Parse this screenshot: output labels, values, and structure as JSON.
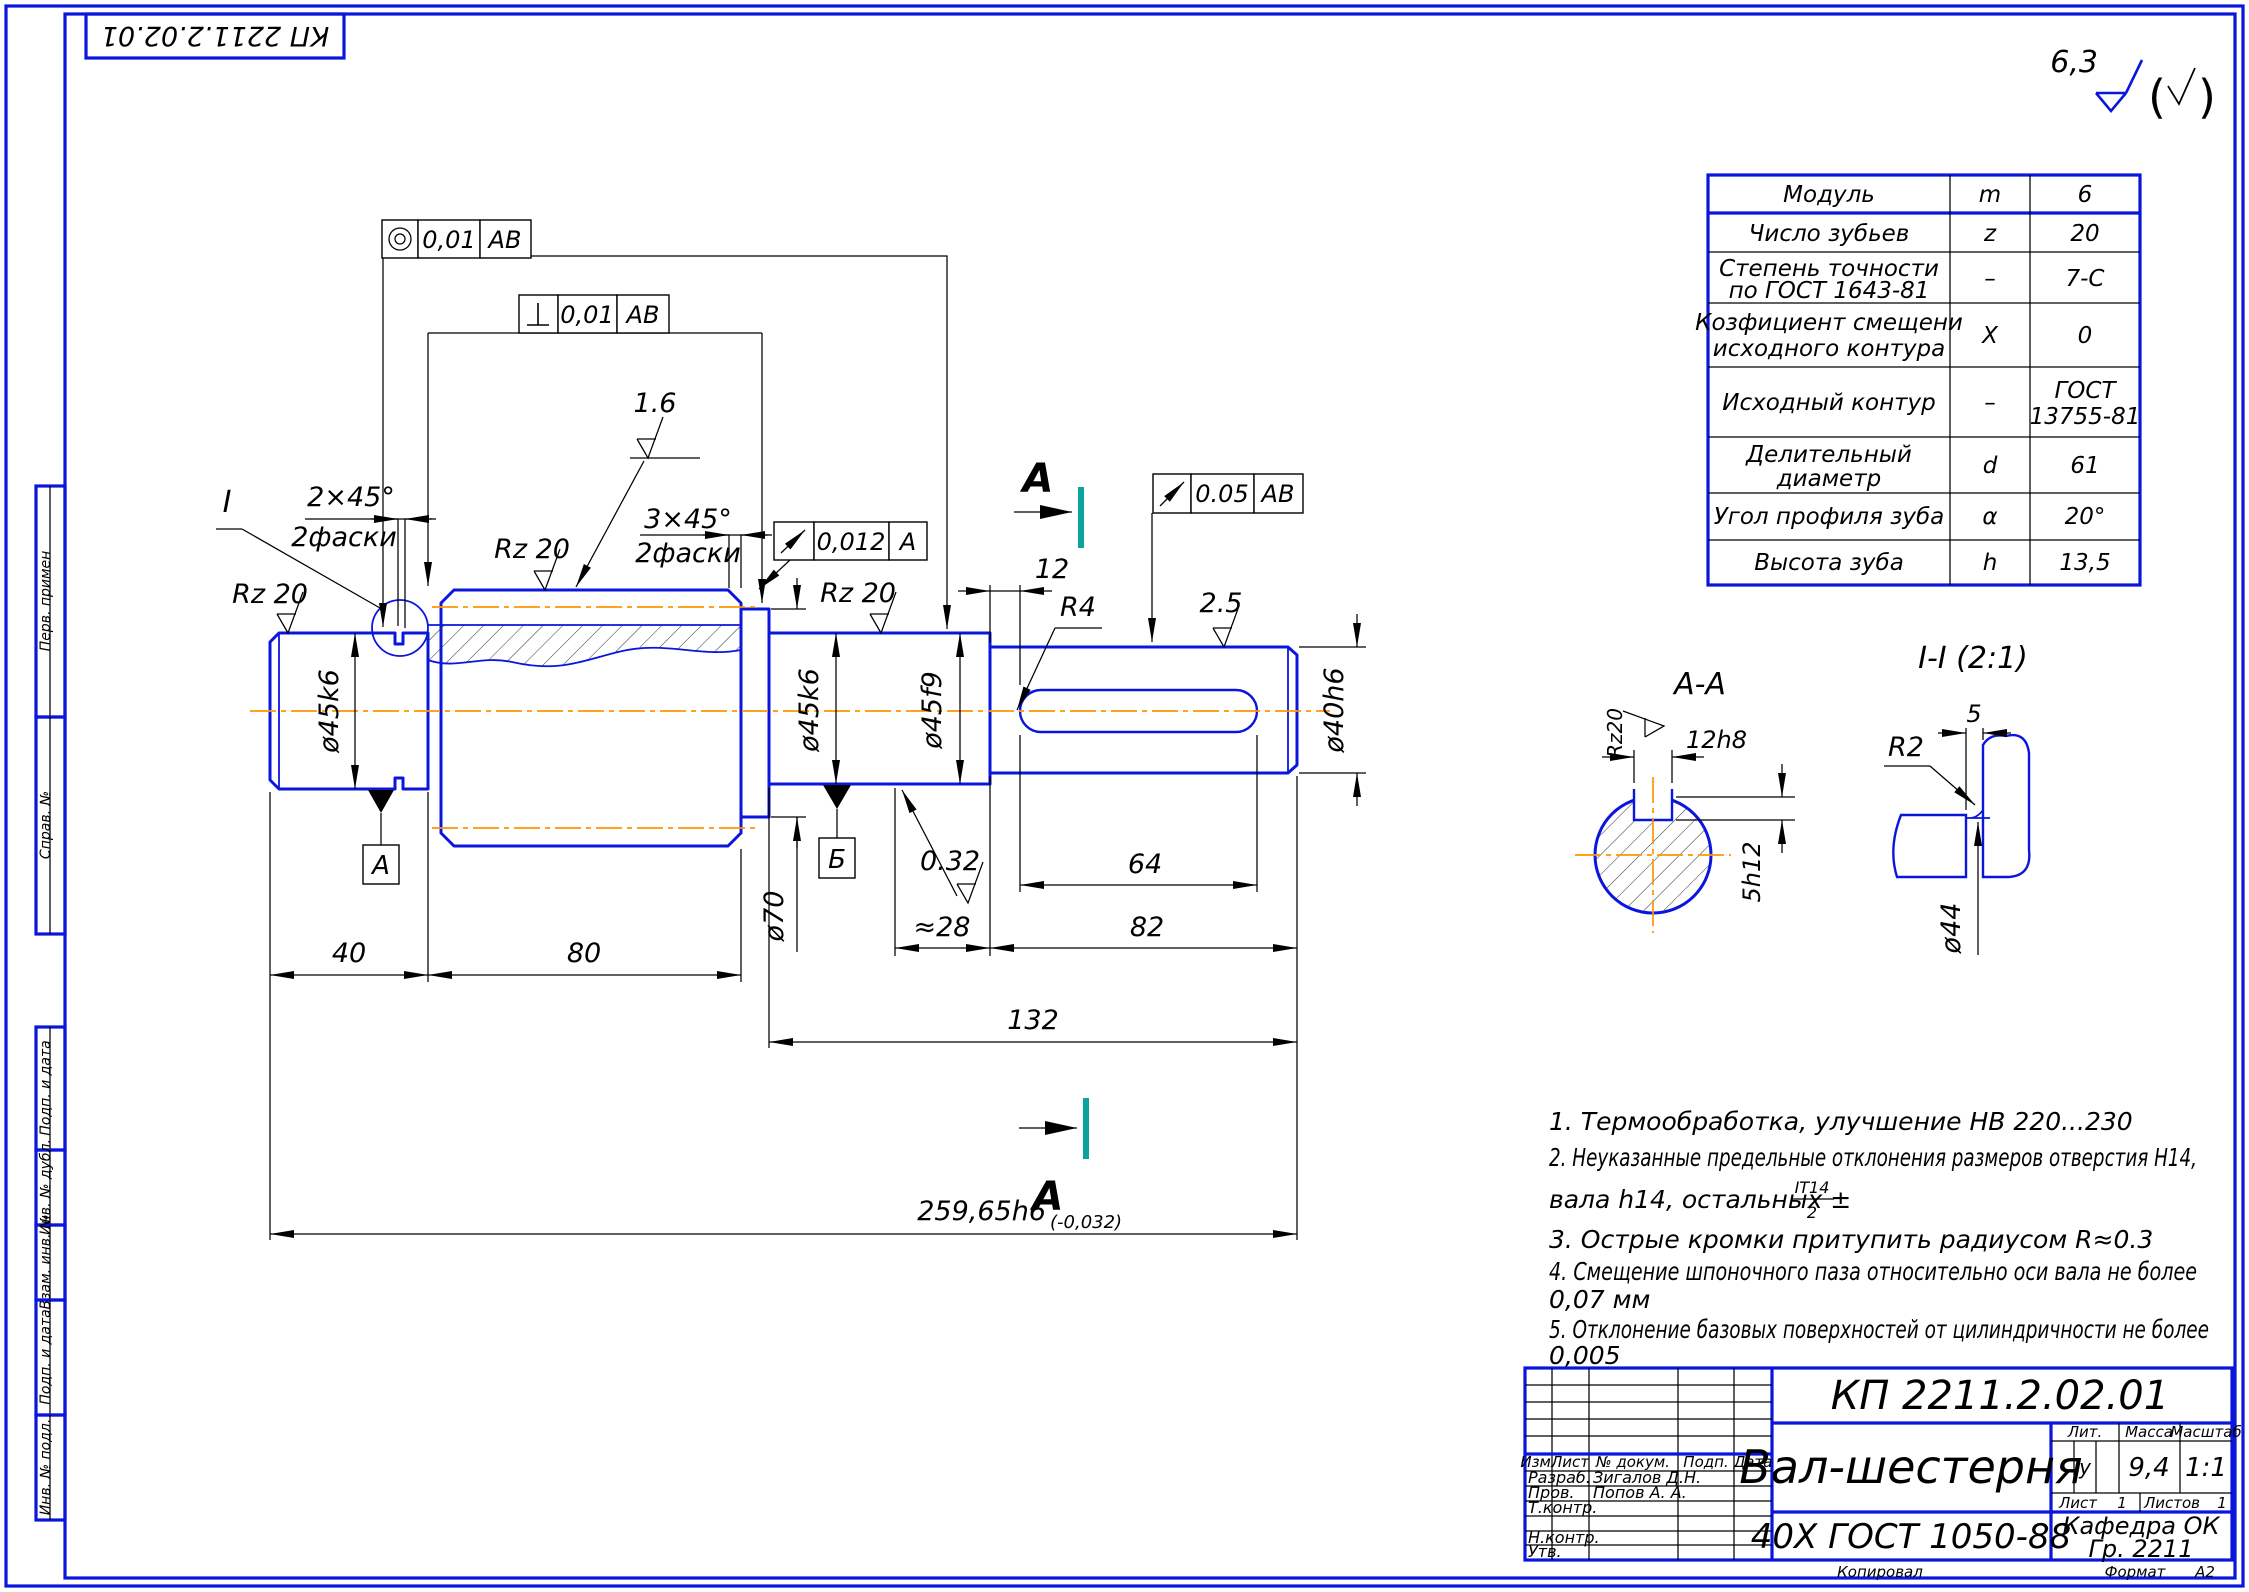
{
  "page": {
    "stamp": "КП 2211.2.02.01"
  },
  "general": {
    "roughness": "6,3"
  },
  "sidebar": {
    "cells": [
      "Перв. примен",
      "Справ. №",
      "Подп. и дата",
      "Инв. № дубл.",
      "Взам. инв. №",
      "Подп. и дата",
      "Инв. № подл."
    ]
  },
  "drawing": {
    "roughness": {
      "rz20": "Rz 20",
      "rz20c": "Rz20",
      "r16": "1.6",
      "r25": "2.5",
      "r032": "0.32"
    },
    "chamfers": {
      "c2": "2×45°",
      "c3": "3×45°",
      "faski": "2фаски"
    },
    "diameters": {
      "d45k6": "ø45k6",
      "d45f9": "ø45f9",
      "d40h6": "ø40h6",
      "d70": "ø70",
      "d44": "ø44"
    },
    "lengths": {
      "l40": "40",
      "l80": "80",
      "l28": "≈28",
      "l82": "82",
      "l64": "64",
      "l132": "132",
      "l12": "12",
      "total": "259,65h6",
      "total_tol": "(-0,032)"
    },
    "radii": {
      "r4": "R4",
      "r2": "R2"
    },
    "keyway": {
      "w": "12h8",
      "d": "5h12",
      "groove": "5"
    },
    "datums": {
      "a": "А",
      "b": "Б"
    },
    "sections": {
      "a": "А",
      "aa": "А-А",
      "ii": "I-I (2:1)",
      "detail": "I"
    },
    "frames": {
      "f1": {
        "val": "0,01",
        "ref": "АВ"
      },
      "f2": {
        "val": "0,01",
        "ref": "АВ"
      },
      "f3": {
        "val": "0,012",
        "ref": "А"
      },
      "f4": {
        "val": "0.05",
        "ref": "АВ"
      }
    }
  },
  "gear_table": {
    "rows": [
      {
        "l1": "Модуль",
        "l2": "",
        "sym": "m",
        "v1": "6",
        "v2": ""
      },
      {
        "l1": "Число зубьев",
        "l2": "",
        "sym": "z",
        "v1": "20",
        "v2": ""
      },
      {
        "l1": "Степень точности",
        "l2": "по ГОСТ 1643-81",
        "sym": "–",
        "v1": "7-С",
        "v2": ""
      },
      {
        "l1": "Козфициент смещени",
        "l2": "исходного контура",
        "sym": "X",
        "v1": "0",
        "v2": ""
      },
      {
        "l1": "Исходный контур",
        "l2": "",
        "sym": "–",
        "v1": "ГОСТ",
        "v2": "13755-81"
      },
      {
        "l1": "Делительный",
        "l2": "диаметр",
        "sym": "d",
        "v1": "61",
        "v2": ""
      },
      {
        "l1": "Угол профиля зуба",
        "l2": "",
        "sym": "α",
        "v1": "20°",
        "v2": ""
      },
      {
        "l1": "Высота зуба",
        "l2": "",
        "sym": "h",
        "v1": "13,5",
        "v2": ""
      }
    ]
  },
  "notes": {
    "n1": "1. Термообработка, улучшение НВ 220...230",
    "n2a": "2. Неуказанные предельные отклонения размеров отверстия Н14,",
    "n2b": "вала h14, остальных ±",
    "frac_top": "IT14",
    "frac_bot": "2",
    "n3": "3. Острые кромки притупить радиусом R≈0.3",
    "n4a": "4. Смещение шпоночного паза относительно оси вала не более",
    "n4b": "0,07 мм",
    "n5a": "5. Отклонение базовых поверхностей от цилиндричности не более",
    "n5b": "0,005"
  },
  "title_block": {
    "doc_number": "КП 2211.2.02.01",
    "part_name": "Вал-шестерня",
    "material": "40Х ГОСТ 1050-88",
    "lit_label": "Лит.",
    "lit_value": "у",
    "mass_label": "Масса",
    "mass_value": "9,4",
    "scale_label": "Масштаб",
    "scale_value": "1:1",
    "sheet_label": "Лист",
    "sheet_value": "1",
    "sheets_label": "Листов",
    "sheets_value": "1",
    "org": "Кафедра ОК",
    "group": "Гр. 2211",
    "col_izm": "Изм.",
    "col_list": "Лист",
    "col_doc": "№ докум.",
    "col_sign": "Подп.",
    "col_date": "Дата",
    "row_razrab": "Разраб.",
    "razrab_name": "Зигалов Д.Н.",
    "row_prov": "Пров.",
    "prov_name": "Попов А. А.",
    "row_tkontr": "Т.контр.",
    "row_nkontr": "Н.контр.",
    "row_utv": "Утв.",
    "kopiroval": "Копировал",
    "format_label": "Формат",
    "format_value": "А2"
  }
}
